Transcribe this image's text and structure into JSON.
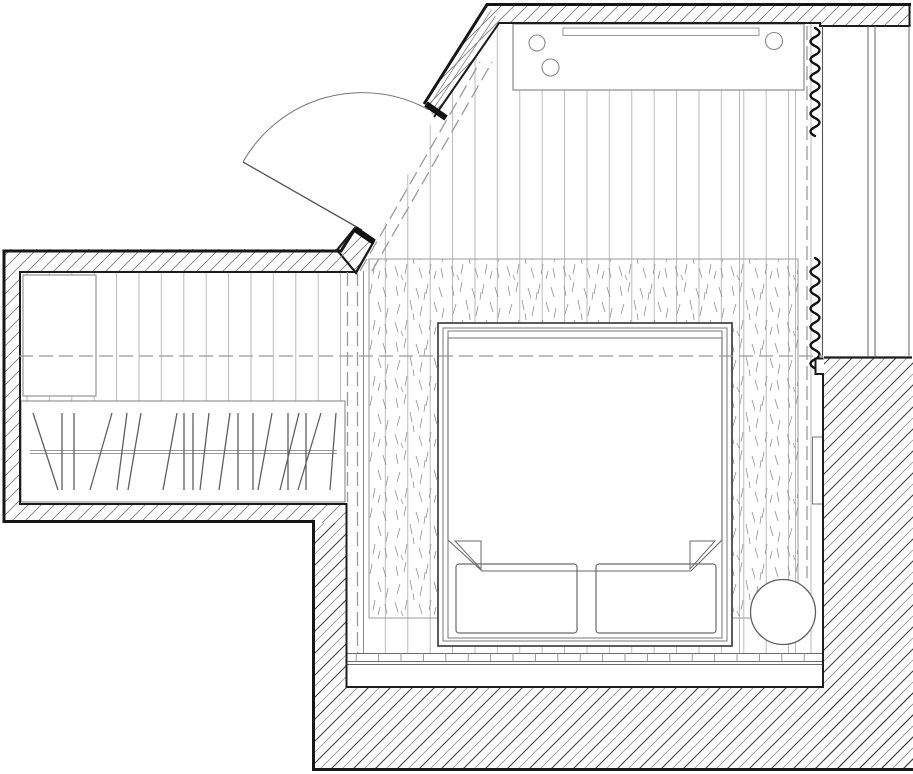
{
  "meta": {
    "drawing_kind": "architectural floor plan, bedroom with wardrobe area",
    "canvas": {
      "width": 913,
      "height": 774
    },
    "palette": {
      "paper": "#ffffff",
      "wall_outline": "#161616",
      "room_outline": "#1c1c1c",
      "medium_line": "#666666",
      "light_line": "#9a9a9a",
      "plank_line": "#b2b2b2",
      "dashed_line": "#9a9a9a",
      "curtain_line": "#111111"
    }
  },
  "plan": {
    "elements": [
      {
        "tag": "rect",
        "name": "paper-background",
        "attrs": {
          "x": 0,
          "y": 0,
          "width": 913,
          "height": 774,
          "fill": "#ffffff"
        }
      },
      {
        "tag": "polygon",
        "name": "floor-planks-main",
        "attrs": {
          "points": "499,22 822,22 822,653 363,653 363,272 434,117",
          "fill": "url(#pat-planks)"
        }
      },
      {
        "tag": "rect",
        "name": "floor-planks-closet",
        "attrs": {
          "x": 19,
          "y": 271,
          "width": 326,
          "height": 231,
          "fill": "url(#pat-planks)"
        }
      },
      {
        "tag": "path",
        "name": "floor-board-joints",
        "attrs": {
          "d": "M739.5,22 V653 M795.5,22 V653",
          "stroke": "#b2b2b2",
          "stroke-width": 0.9,
          "fill": "none"
        }
      },
      {
        "tag": "path",
        "name": "floor-edge-line",
        "attrs": {
          "d": "M363.5,271 V653",
          "stroke": "#8f8f8f",
          "stroke-width": 1,
          "fill": "none"
        }
      },
      {
        "tag": "rect",
        "name": "area-rug",
        "attrs": {
          "x": 369,
          "y": 259,
          "width": 429,
          "height": 359,
          "fill": "url(#pat-carpet)",
          "stroke": "#9a9a9a",
          "stroke-width": 1
        }
      },
      {
        "tag": "path",
        "name": "floor-threshold-lines",
        "attrs": {
          "d": "M347,653.5 H823 M347,661.5 H823 M347,664.5 H823",
          "stroke": "#6a6a6a",
          "stroke-width": 1.1,
          "fill": "none"
        }
      },
      {
        "tag": "path",
        "name": "floor-threshold-ticks",
        "attrs": {
          "d": "M356.2,653 V661.5 M378.6,653 V661.5 M401,653 V661.5 M423.4,653 V661.5 M445.8,653 V661.5 M468.2,653 V661.5 M490.6,653 V661.5 M513,653 V661.5 M535.4,653 V661.5 M557.8,653 V661.5 M580.2,653 V661.5 M602.6,653 V661.5 M625,653 V661.5 M647.4,653 V661.5 M669.8,653 V661.5 M692.2,653 V661.5 M714.6,653 V661.5 M737,653 V661.5 M759.4,653 V661.5 M781.8,653 V661.5 M804.2,653 V661.5",
          "stroke": "#8f8f8f",
          "stroke-width": 0.9,
          "fill": "none"
        }
      },
      {
        "tag": "rect",
        "name": "console-table",
        "attrs": {
          "x": 513,
          "y": 24,
          "width": 291,
          "height": 66,
          "fill": "#ffffff",
          "stroke": "#8a8a8a",
          "stroke-width": 1.2
        }
      },
      {
        "tag": "rect",
        "name": "console-tray",
        "attrs": {
          "x": 563,
          "y": 28,
          "width": 196,
          "height": 7.5,
          "fill": "#ffffff",
          "stroke": "#9a9a9a",
          "stroke-width": 1
        }
      },
      {
        "tag": "circle",
        "name": "console-object-1",
        "attrs": {
          "cx": 537,
          "cy": 43,
          "r": 8,
          "fill": "#ffffff",
          "stroke": "#8a8a8a",
          "stroke-width": 1.1
        }
      },
      {
        "tag": "circle",
        "name": "console-object-2",
        "attrs": {
          "cx": 550.5,
          "cy": 67.5,
          "r": 8.5,
          "fill": "#ffffff",
          "stroke": "#8a8a8a",
          "stroke-width": 1.1
        }
      },
      {
        "tag": "circle",
        "name": "console-object-3",
        "attrs": {
          "cx": 774,
          "cy": 41,
          "r": 8.5,
          "fill": "#ffffff",
          "stroke": "#8a8a8a",
          "stroke-width": 1.1
        }
      },
      {
        "tag": "rect",
        "name": "closet-cabinet",
        "attrs": {
          "x": 23,
          "y": 275,
          "width": 73,
          "height": 121,
          "fill": "#ffffff",
          "stroke": "#8a8a8a",
          "stroke-width": 1.1
        }
      },
      {
        "tag": "rect",
        "name": "wardrobe-zone",
        "attrs": {
          "x": 21,
          "y": 401,
          "width": 324,
          "height": 101,
          "fill": "#ffffff",
          "stroke": "#8a8a8a",
          "stroke-width": 1.1
        }
      },
      {
        "tag": "path",
        "name": "wardrobe-rail",
        "attrs": {
          "d": "M30,450.5 H337 M30,453.5 H337",
          "stroke": "#999999",
          "stroke-width": 1,
          "fill": "none"
        }
      },
      {
        "tag": "path",
        "name": "clothes-hangers",
        "attrs": {
          "d": "M33,413 L58,490 M62,413 L62,490 M74,413 L74,490 M112,413 L90,490 M127,413 L117,490 M141,413 L128,490 M177,413 L163,490 M184,413 L184,490 M193,413 L193,490 M209,413 L200,490 M230,413 L219,490 M238,413 L238,490 M253,413 L253,490 M272,413 L258,490 M288,413 L288,490 M299,413 L280,490 M306,413 L306,490 M321,413 L298,490 M336,413 L330,490",
          "stroke": "#5f5f5f",
          "stroke-width": 1.3,
          "fill": "none"
        }
      },
      {
        "tag": "rect",
        "name": "bed-frame",
        "attrs": {
          "x": 438,
          "y": 323,
          "width": 294,
          "height": 323,
          "fill": "#ffffff",
          "stroke": "#3f3f3f",
          "stroke-width": 1.7
        }
      },
      {
        "tag": "rect",
        "name": "bed-frame-inner",
        "attrs": {
          "x": 443,
          "y": 328,
          "width": 284,
          "height": 313,
          "fill": "none",
          "stroke": "#777777",
          "stroke-width": 1
        }
      },
      {
        "tag": "rect",
        "name": "bed-mattress",
        "attrs": {
          "x": 448,
          "y": 331,
          "width": 274,
          "height": 307,
          "fill": "none",
          "stroke": "#777777",
          "stroke-width": 1
        }
      },
      {
        "tag": "path",
        "name": "bed-sheet-line",
        "attrs": {
          "d": "M448,338 H722",
          "stroke": "#777777",
          "stroke-width": 1,
          "fill": "none"
        }
      },
      {
        "tag": "polygon",
        "name": "duvet",
        "attrs": {
          "points": "448,338 722,338 722,540 691,571 482,571 448,540",
          "fill": "#ffffff",
          "stroke": "#6a6a6a",
          "stroke-width": 1.1
        }
      },
      {
        "tag": "polygon",
        "name": "duvet-fold-left",
        "attrs": {
          "points": "455,541 481,541 481,569",
          "fill": "#ffffff",
          "stroke": "#6a6a6a",
          "stroke-width": 1
        }
      },
      {
        "tag": "polygon",
        "name": "duvet-fold-right",
        "attrs": {
          "points": "715,541 690,541 690,569",
          "fill": "#ffffff",
          "stroke": "#6a6a6a",
          "stroke-width": 1
        }
      },
      {
        "tag": "rect",
        "name": "pillow-left",
        "attrs": {
          "x": 456,
          "y": 564,
          "width": 121,
          "height": 69,
          "rx": 3,
          "fill": "none",
          "stroke": "#6a6a6a",
          "stroke-width": 1.2
        }
      },
      {
        "tag": "rect",
        "name": "pillow-right",
        "attrs": {
          "x": 596,
          "y": 564,
          "width": 120,
          "height": 69,
          "rx": 3,
          "fill": "none",
          "stroke": "#6a6a6a",
          "stroke-width": 1.2
        }
      },
      {
        "tag": "circle",
        "name": "pouf",
        "attrs": {
          "cx": 783,
          "cy": 612,
          "r": 32.5,
          "fill": "#ffffff",
          "stroke": "#5f5f5f",
          "stroke-width": 1.3
        }
      },
      {
        "tag": "rect",
        "name": "radiator",
        "attrs": {
          "x": 812.5,
          "y": 437,
          "width": 10,
          "height": 67,
          "fill": "#ffffff",
          "stroke": "#777777",
          "stroke-width": 1
        }
      },
      {
        "tag": "polygon",
        "name": "wall-top",
        "attrs": {
          "points": "487,3 911,3 911,26 820,26 820,22 499,22",
          "fill": "url(#pat-hatch-thin)"
        }
      },
      {
        "tag": "polygon",
        "name": "wall-entry-diagonal",
        "attrs": {
          "points": "487,3 499,22 434,117 424,103",
          "fill": "url(#pat-hatch-thin)"
        }
      },
      {
        "tag": "path",
        "name": "wall-entry-layers",
        "attrs": {
          "d": "M491.5,9.8 L428,107.6 M495.5,16 L431,112.4",
          "stroke": "#888888",
          "stroke-width": 0.8,
          "fill": "none"
        }
      },
      {
        "tag": "polygon",
        "name": "wall-entry-stub",
        "attrs": {
          "points": "355,228 374,241 356,273 337,250",
          "fill": "url(#pat-hatch-thin)",
          "stroke": "#1c1c1c",
          "stroke-width": 2.2
        }
      },
      {
        "tag": "polygon",
        "name": "wall-closet",
        "attrs": {
          "points": "3,249 347,249 347,271 19,271 19,505 347,505 347,523 3,523",
          "fill": "url(#pat-hatch-thin)"
        }
      },
      {
        "tag": "rect",
        "name": "wall-lower-left",
        "attrs": {
          "x": 313,
          "y": 523,
          "width": 34,
          "height": 165,
          "fill": "url(#pat-hatch-thick)"
        }
      },
      {
        "tag": "rect",
        "name": "wall-bottom",
        "attrs": {
          "x": 313,
          "y": 688,
          "width": 600,
          "height": 83,
          "fill": "url(#pat-hatch-thick)"
        }
      },
      {
        "tag": "rect",
        "name": "wall-right",
        "attrs": {
          "x": 824,
          "y": 357,
          "width": 89,
          "height": 414,
          "fill": "url(#pat-hatch-thick)"
        }
      },
      {
        "tag": "path",
        "name": "wall-outline-top",
        "attrs": {
          "d": "M424,104 L487,4.5 H911",
          "stroke": "#161616",
          "stroke-width": 3,
          "fill": "none"
        }
      },
      {
        "tag": "path",
        "name": "wall-outline-left-bottom",
        "attrs": {
          "d": "M355,229 L341,251 L4,251 V521.5 H313.5 V769.5 H913",
          "stroke": "#161616",
          "stroke-width": 3,
          "fill": "none"
        }
      },
      {
        "tag": "path",
        "name": "wall-inner-top",
        "attrs": {
          "d": "M434,117 L499,23 H820 V26 H909.5 V5",
          "stroke": "#1c1c1c",
          "stroke-width": 2,
          "fill": "none"
        }
      },
      {
        "tag": "path",
        "name": "wall-inner-room",
        "attrs": {
          "d": "M373,243 L356,272 H20 V504 H346.5 V687 H823 V374 H815.5 V358.5 H823.5",
          "stroke": "#1c1c1c",
          "stroke-width": 2,
          "fill": "none"
        }
      },
      {
        "tag": "path",
        "name": "wall-right-top-edge",
        "attrs": {
          "d": "M824,357.5 H912",
          "stroke": "#1c1c1c",
          "stroke-width": 2.2,
          "fill": "none"
        }
      },
      {
        "tag": "path",
        "name": "window-frame-left",
        "attrs": {
          "d": "M822.5,26 V357",
          "stroke": "#555555",
          "stroke-width": 1.1,
          "fill": "none"
        }
      },
      {
        "tag": "path",
        "name": "window-glazing",
        "attrs": {
          "d": "M868,26 V357 M875,26 V357",
          "stroke": "#666666",
          "stroke-width": 1,
          "fill": "none"
        }
      },
      {
        "tag": "path",
        "name": "window-frame-right",
        "attrs": {
          "d": "M909,26 V357",
          "stroke": "#666666",
          "stroke-width": 1,
          "fill": "none"
        }
      },
      {
        "tag": "path",
        "name": "curtain-upper",
        "attrs": {
          "d": "M815,28 Q824,32.5 815,37 Q806,41.5 815,46 Q824,50.5 815,55 Q806,59.5 815,64 Q824,68.5 815,73 Q806,77.5 815,82 Q824,86.5 815,91 Q806,95.5 815,100 Q824,104.5 815,109 Q806,113.5 815,118 Q824,122.5 815,127 Q806,131.5 815,136",
          "stroke": "#111111",
          "stroke-width": 2.4,
          "fill": "none",
          "stroke-linecap": "round"
        }
      },
      {
        "tag": "path",
        "name": "curtain-lower",
        "attrs": {
          "d": "M815,258 Q824,262.6 815,267.2 Q806,271.8 815,276.4 Q824,281 815,285.6 Q806,290.2 815,294.8 Q824,299.4 815,304 Q806,308.6 815,313.2 Q824,317.8 815,322.4 Q806,327 815,331.6 Q824,336.2 815,340.8 Q806,345.4 815,350 Q824,354.6 815,359.2 Q806,363.8 815,368.4",
          "stroke": "#111111",
          "stroke-width": 2.4,
          "fill": "none",
          "stroke-linecap": "round"
        }
      },
      {
        "tag": "path",
        "name": "door-leaf",
        "attrs": {
          "d": "M362,230 L243,162",
          "stroke": "#555555",
          "stroke-width": 1.3,
          "fill": "none"
        }
      },
      {
        "tag": "path",
        "name": "door-swing-arc",
        "attrs": {
          "d": "M243,162 A137,137 0 0 1 429,110",
          "stroke": "#777777",
          "stroke-width": 1,
          "fill": "none"
        }
      },
      {
        "tag": "path",
        "name": "door-jamb-hinge",
        "attrs": {
          "d": "M355,229 L374,242",
          "stroke": "#111111",
          "stroke-width": 6,
          "fill": "none"
        }
      },
      {
        "tag": "path",
        "name": "door-jamb-strike",
        "attrs": {
          "d": "M426,104 L446,118",
          "stroke": "#111111",
          "stroke-width": 6,
          "fill": "none"
        }
      },
      {
        "tag": "path",
        "name": "ceiling-break-line-horizontal",
        "attrs": {
          "d": "M19,356 H823",
          "stroke": "#9a9a9a",
          "stroke-width": 1.3,
          "stroke-dasharray": "14 6",
          "fill": "none"
        }
      },
      {
        "tag": "path",
        "name": "ceiling-break-line-window",
        "attrs": {
          "d": "M807,26 V578",
          "stroke": "#9a9a9a",
          "stroke-width": 1.3,
          "stroke-dasharray": "14 6",
          "fill": "none"
        }
      },
      {
        "tag": "path",
        "name": "ceiling-break-line-closet-a",
        "attrs": {
          "d": "M347.5,272 V502",
          "stroke": "#9a9a9a",
          "stroke-width": 1.3,
          "stroke-dasharray": "14 6",
          "fill": "none"
        }
      },
      {
        "tag": "path",
        "name": "ceiling-break-line-closet-b",
        "attrs": {
          "d": "M357.5,272 V653",
          "stroke": "#9a9a9a",
          "stroke-width": 1.3,
          "stroke-dasharray": "14 6",
          "fill": "none"
        }
      },
      {
        "tag": "path",
        "name": "ceiling-break-line-entry-a",
        "attrs": {
          "d": "M360,271 L480,62",
          "stroke": "#9a9a9a",
          "stroke-width": 1.3,
          "stroke-dasharray": "14 6",
          "fill": "none"
        }
      },
      {
        "tag": "path",
        "name": "ceiling-break-line-entry-b",
        "attrs": {
          "d": "M372,271 L492,62",
          "stroke": "#9a9a9a",
          "stroke-width": 1.3,
          "stroke-dasharray": "14 6",
          "fill": "none"
        }
      }
    ]
  }
}
